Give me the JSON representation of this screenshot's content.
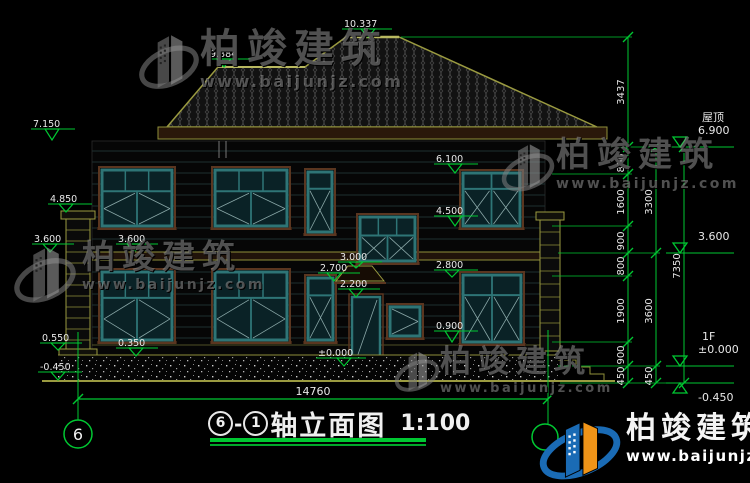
{
  "watermark": {
    "name": "柏竣建筑",
    "url": "www.baijunjz.com"
  },
  "logo": {
    "name": "柏竣建筑",
    "url": "www.baijunjz.com"
  },
  "title": {
    "circle_left": "6",
    "separator": "-",
    "circle_right": "1",
    "text": "轴立面图",
    "scale": "1:100"
  },
  "axis": {
    "bubble_label": "6"
  },
  "colors": {
    "line_green": "#00c832",
    "roof_outline": "#9a9a40",
    "window_teal": "#2e7576",
    "underline_green": "#00c832",
    "logo_blue": "#1a6bb5",
    "logo_orange": "#ef9418"
  },
  "drawing": {
    "overall_width_label": "14760",
    "elevation_markers": [
      {
        "label": "10.337",
        "tx": 344,
        "ty": 27,
        "lw": 48,
        "ax": 368,
        "ay": 37
      },
      {
        "label": "9.384",
        "tx": 210,
        "ty": 57,
        "lw": 42,
        "ax": 224,
        "ay": 67
      },
      {
        "label": "7.150",
        "tx": 33,
        "ty": 127,
        "lw": 42,
        "ax": 52,
        "ay": 140
      },
      {
        "label": "4.850",
        "tx": 50,
        "ty": 202,
        "lw": 42,
        "ax": 66,
        "ay": 212
      },
      {
        "label": "3.600",
        "tx": 34,
        "ty": 242,
        "lw": 40,
        "ax": 50,
        "ay": 252
      },
      {
        "label": "3.600",
        "tx": 118,
        "ty": 242,
        "lw": 40,
        "ax": 134,
        "ay": 252
      },
      {
        "label": "6.100",
        "tx": 436,
        "ty": 162,
        "lw": 42,
        "ax": 455,
        "ay": 173
      },
      {
        "label": "4.500",
        "tx": 436,
        "ty": 214,
        "lw": 42,
        "ax": 455,
        "ay": 226
      },
      {
        "label": "3.000",
        "tx": 340,
        "ty": 260,
        "lw": 42,
        "ax": 356,
        "ay": 268
      },
      {
        "label": "2.700",
        "tx": 320,
        "ty": 271,
        "lw": 40,
        "ax": 334,
        "ay": 281
      },
      {
        "label": "2.200",
        "tx": 340,
        "ty": 287,
        "lw": 40,
        "ax": 356,
        "ay": 297
      },
      {
        "label": "2.800",
        "tx": 436,
        "ty": 268,
        "lw": 42,
        "ax": 452,
        "ay": 277
      },
      {
        "label": "0.900",
        "tx": 436,
        "ty": 329,
        "lw": 42,
        "ax": 452,
        "ay": 342
      },
      {
        "label": "0.350",
        "tx": 118,
        "ty": 346,
        "lw": 40,
        "ax": 136,
        "ay": 356
      },
      {
        "label": "±0.000",
        "tx": 318,
        "ty": 356,
        "lw": 48,
        "ax": 344,
        "ay": 366
      },
      {
        "label": "0.550",
        "tx": 42,
        "ty": 341,
        "lw": 40,
        "ax": 58,
        "ay": 350
      },
      {
        "label": "-0.450",
        "tx": 40,
        "ty": 370,
        "lw": 42,
        "ax": 58,
        "ay": 380
      }
    ],
    "right_levels": [
      {
        "name": "屋顶",
        "value": "6.900",
        "y": 147,
        "below": false
      },
      {
        "name": "",
        "value": "3.600",
        "y": 253,
        "below": false
      },
      {
        "name": "1F",
        "value": "±0.000",
        "y": 366,
        "below": false
      },
      {
        "name": "",
        "value": "-0.450",
        "y": 383,
        "below": true
      }
    ],
    "dim_chains": [
      {
        "x": 628,
        "ticks": [
          37,
          147,
          174,
          226,
          253,
          276,
          342,
          366,
          383
        ],
        "labels": [
          {
            "t": "3437",
            "y": 92
          },
          {
            "t": "800",
            "y": 163
          },
          {
            "t": "1600",
            "y": 202
          },
          {
            "t": "900",
            "y": 241
          },
          {
            "t": "800",
            "y": 266
          },
          {
            "t": "1900",
            "y": 311
          },
          {
            "t": "900",
            "y": 355
          },
          {
            "t": "450",
            "y": 376
          }
        ]
      },
      {
        "x": 656,
        "ticks": [
          147,
          253,
          366,
          383
        ],
        "labels": [
          {
            "t": "3300",
            "y": 202
          },
          {
            "t": "3600",
            "y": 311
          },
          {
            "t": "450",
            "y": 376
          }
        ]
      },
      {
        "x": 684,
        "ticks": [
          147,
          383
        ],
        "labels": [
          {
            "t": "7350",
            "y": 266
          }
        ]
      }
    ],
    "extensions": [
      {
        "y": 37,
        "x1": 401,
        "x2": 632
      },
      {
        "y": 147,
        "x1": 600,
        "x2": 688
      },
      {
        "y": 174,
        "x1": 552,
        "x2": 632
      },
      {
        "y": 226,
        "x1": 552,
        "x2": 632
      },
      {
        "y": 253,
        "x1": 558,
        "x2": 660
      },
      {
        "y": 276,
        "x1": 552,
        "x2": 632
      },
      {
        "y": 342,
        "x1": 552,
        "x2": 632
      },
      {
        "y": 366,
        "x1": 558,
        "x2": 660
      },
      {
        "y": 383,
        "x1": 560,
        "x2": 688
      }
    ],
    "windows": [
      {
        "x": 102,
        "y": 170,
        "w": 70,
        "h": 56,
        "kind": "double"
      },
      {
        "x": 215,
        "y": 170,
        "w": 72,
        "h": 56,
        "kind": "double"
      },
      {
        "x": 308,
        "y": 172,
        "w": 24,
        "h": 60,
        "kind": "narrow"
      },
      {
        "x": 463,
        "y": 173,
        "w": 57,
        "h": 53,
        "kind": "xpanes"
      },
      {
        "x": 360,
        "y": 217,
        "w": 55,
        "h": 44,
        "kind": "stair"
      },
      {
        "x": 102,
        "y": 272,
        "w": 70,
        "h": 68,
        "kind": "double"
      },
      {
        "x": 215,
        "y": 272,
        "w": 72,
        "h": 68,
        "kind": "double"
      },
      {
        "x": 308,
        "y": 278,
        "w": 25,
        "h": 62,
        "kind": "narrow"
      },
      {
        "x": 390,
        "y": 307,
        "w": 30,
        "h": 29,
        "kind": "small"
      },
      {
        "x": 463,
        "y": 275,
        "w": 58,
        "h": 67,
        "kind": "xpanes"
      }
    ]
  }
}
